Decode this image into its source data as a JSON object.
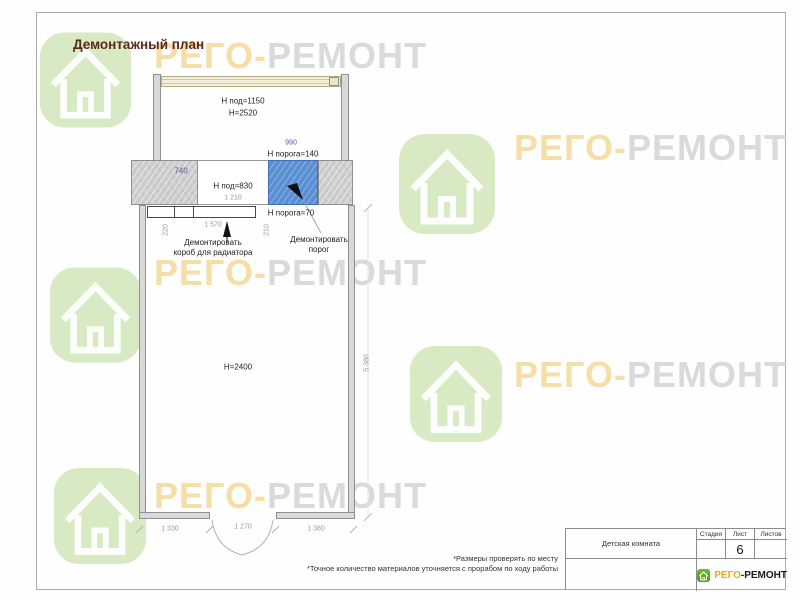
{
  "page": {
    "title": "Демонтажный план"
  },
  "watermark": {
    "part1": "РЕГО-",
    "part2": "РЕМОНТ",
    "house_color": "#d7eac4",
    "text_color_1": "#f6dfa6",
    "text_color_2": "#dadada"
  },
  "plan": {
    "h_pod_1150": "Н под=1150",
    "h_2520": "Н=2520",
    "dim_740": "740",
    "dim_990": "990",
    "h_poroga_140": "Н порога=140",
    "h_pod_830": "Н под=830",
    "dim_1210": "1 210",
    "h_poroga_70": "Н порога=70",
    "dim_220": "220",
    "dim_1570": "1 570",
    "dim_210": "210",
    "radiator_label_1": "Демонтировать",
    "radiator_label_2": "короб для радиатора",
    "porog_label_1": "Демонтировать",
    "porog_label_2": "порог",
    "h_2400": "Н=2400",
    "dim_5380": "5 380",
    "dim_1330": "1 330",
    "dim_1270": "1 270",
    "dim_1380": "1 380",
    "demolition_color": "#5b8fd4",
    "wall_color": "#cdcdcd",
    "dim_blue_color": "#5858a8"
  },
  "notes": [
    "*Размеры проверять по месту",
    "*Точное количество материалов уточняется с прорабом по ходу работы"
  ],
  "titleblock": {
    "room_name": "Детская комната",
    "stage_label": "Стадия",
    "sheet_label": "Лист",
    "sheets_label": "Листов",
    "sheet_number": "6"
  },
  "logo": {
    "part1": "РЕГО",
    "part2": "-РЕМОНТ",
    "green": "#4aa81e",
    "orange": "#f2a71b"
  }
}
